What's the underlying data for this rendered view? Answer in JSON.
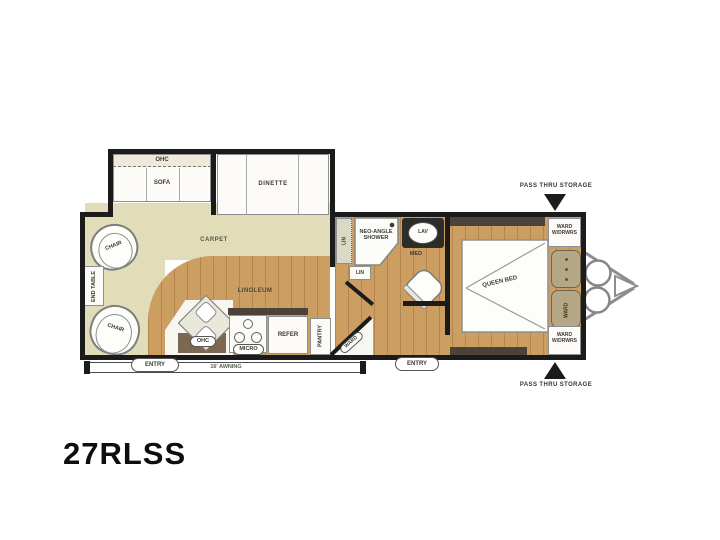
{
  "title": "27RLSS",
  "colors": {
    "wall": "#1b1b1b",
    "carpet": "#e0ddb8",
    "wood_floor": "#cd9e62",
    "cabinet_dark": "#4d4237",
    "cushion_tan": "#b4a785",
    "background": "#ffffff"
  },
  "rooms": {
    "living": {
      "ohc": "OHC",
      "sofa": "SOFA",
      "dinette": "DINETTE",
      "carpet": "CARPET",
      "chair_front": "CHAIR",
      "chair_rear": "CHAIR",
      "end_table": "END TABLE"
    },
    "kitchen": {
      "linoleum": "LINOLEUM",
      "ohc": "OHC",
      "micro": "MICRO",
      "refer": "REFER",
      "pantry": "PANTRY",
      "corner_ward": "WARD"
    },
    "bath": {
      "lin_closet": "LIN",
      "lin_cabinet": "LIN",
      "shower": "NEO-ANGLE SHOWER",
      "lav": "LAV",
      "med": "MED"
    },
    "bedroom": {
      "bed": "QUEEN BED",
      "ward_drwrs_top": "WARD W/DRWRS",
      "ward_drwrs_bottom": "WARD W/DRWRS",
      "ward_side": "WARD"
    },
    "exterior": {
      "entry_main": "ENTRY",
      "entry_bedroom": "ENTRY",
      "awning": "16' AWNING",
      "pass_thru_top": "PASS THRU STORAGE",
      "pass_thru_bottom": "PASS THRU STORAGE"
    }
  }
}
